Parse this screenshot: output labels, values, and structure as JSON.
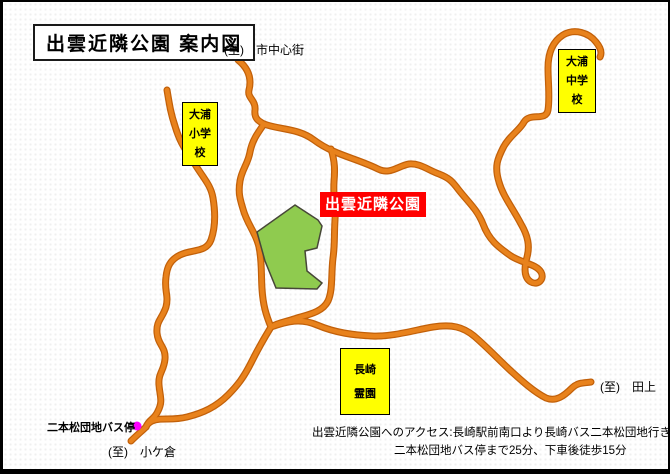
{
  "title": {
    "text": "出雲近隣公園 案内図"
  },
  "map": {
    "to_city": "(至)　市中心街",
    "to_tagami": "(至)　田上",
    "to_kogakura": "(至)　小ケ倉",
    "bus_stop_label": "二本松団地バス停",
    "park_label": "出雲近隣公園",
    "oura_elementary": {
      "line1": "大浦",
      "line2": "小学校"
    },
    "oura_junior_high": {
      "line1": "大浦",
      "line2": "中学校"
    },
    "nagasaki_cemetery": {
      "line1": "長崎",
      "line2": "霊園"
    },
    "access": {
      "line1": "出雲近隣公園へのアクセス:長崎駅前南口より長崎バス二本松団地行き",
      "line2": "二本松団地バス停まで25分、下車後徒歩15分"
    }
  },
  "colors": {
    "road_outer": "#C26009",
    "road_inner": "#E8821C",
    "park_fill": "#8FCB4F",
    "park_stroke": "#474738",
    "label_yellow": "#FFFF00",
    "park_label_bg": "#FF0000",
    "park_label_text": "#FFFFFF",
    "bus_stop_dot": "#FF00FF",
    "frame": "#000000"
  }
}
